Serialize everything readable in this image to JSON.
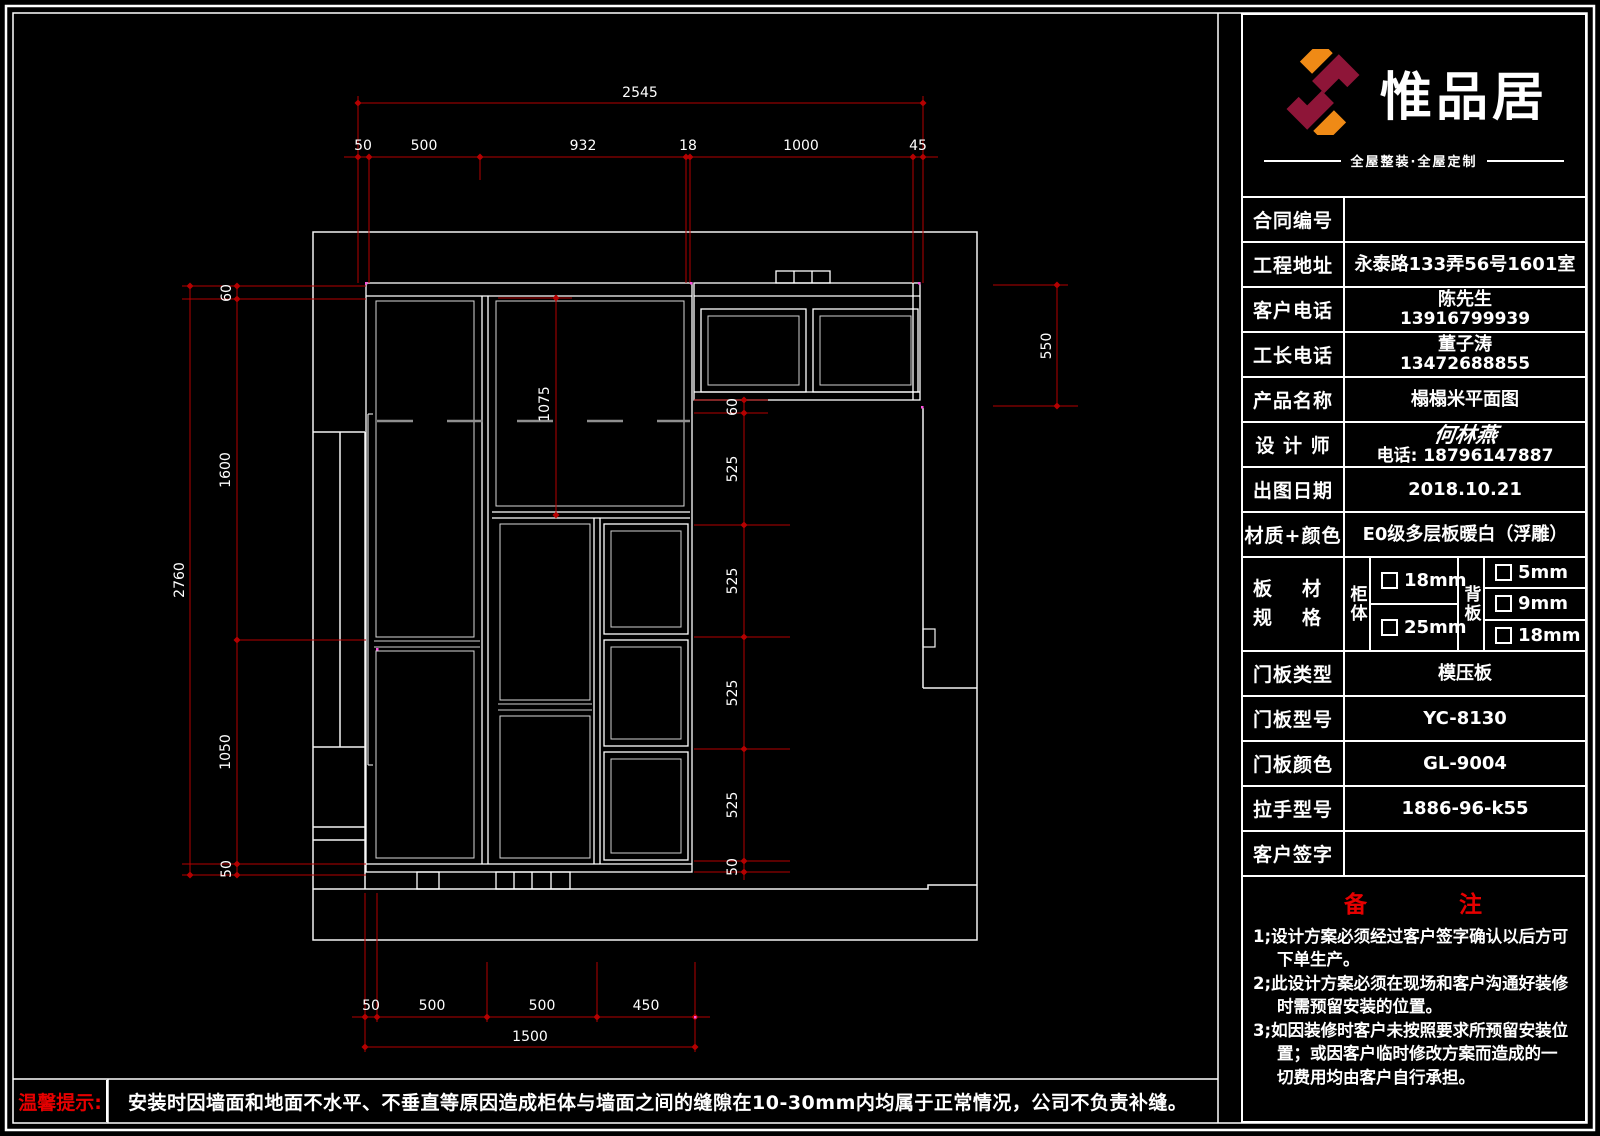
{
  "colors": {
    "dim_red": "#b40000",
    "accent_red": "#e60000",
    "logo_orange": "#ef8a16",
    "logo_maroon": "#8e1538",
    "line_white": "#f2f2f2"
  },
  "brand": {
    "name": "惟品居",
    "tagline": "全屋整装·全屋定制"
  },
  "title_block": {
    "rows": [
      {
        "label": "合同编号",
        "value": "",
        "value2": ""
      },
      {
        "label": "工程地址",
        "value": "永泰路133弄56号1601室",
        "value2": ""
      },
      {
        "label": "客户电话",
        "value": "陈先生",
        "value2": "13916799939"
      },
      {
        "label": "工长电话",
        "value": "董子涛",
        "value2": "13472688855"
      },
      {
        "label": "产品名称",
        "value": "榻榻米平面图",
        "value2": ""
      }
    ],
    "designer": {
      "label": "设 计 师",
      "name": "何林燕",
      "phone": "电话: 18796147887"
    },
    "rows_b": [
      {
        "label": "出图日期",
        "value": "2018.10.21"
      },
      {
        "label": "材质+颜色",
        "value": "E0级多层板暖白（浮雕）"
      }
    ],
    "board": {
      "label_line1": "板材",
      "label_line2": "规格",
      "cabinet": "柜体",
      "back": "背板",
      "cab_options": [
        "18mm",
        "25mm"
      ],
      "back_options": [
        "5mm",
        "9mm",
        "18mm"
      ]
    },
    "rows_c": [
      {
        "label": "门板类型",
        "value": "模压板"
      },
      {
        "label": "门板型号",
        "value": "YC-8130"
      },
      {
        "label": "门板颜色",
        "value": "GL-9004"
      },
      {
        "label": "拉手型号",
        "value": "1886-96-k55"
      },
      {
        "label": "客户签字",
        "value": ""
      }
    ],
    "notes": {
      "title": "备　　　　注",
      "items": [
        "1;设计方案必须经过客户签字确认以后方可下单生产。",
        "2;此设计方案必须在现场和客户沟通好装修时需预留安装的位置。",
        "3;如因装修时客户未按照要求所预留安装位置；或因客户临时修改方案而造成的一切费用均由客户自行承担。"
      ]
    }
  },
  "footer": {
    "label": "温馨提示:",
    "text": "安装时因墙面和地面不水平、不垂直等原因造成柜体与墙面之间的缝隙在10-30mm内均属于正常情况，公司不负责补缝。"
  },
  "dims": {
    "top_total": "2545",
    "top_chain": [
      "50",
      "500",
      "932",
      "18",
      "1000",
      "45"
    ],
    "left_total": "2760",
    "left_chain": [
      "60",
      "1600",
      "1050",
      "50"
    ],
    "cab_height": "550",
    "inner_height": "1075",
    "right_chain": [
      "60",
      "525",
      "525",
      "525",
      "525",
      "50"
    ],
    "bottom_chain": [
      "50",
      "500",
      "500",
      "450"
    ],
    "bottom_total": "1500"
  }
}
